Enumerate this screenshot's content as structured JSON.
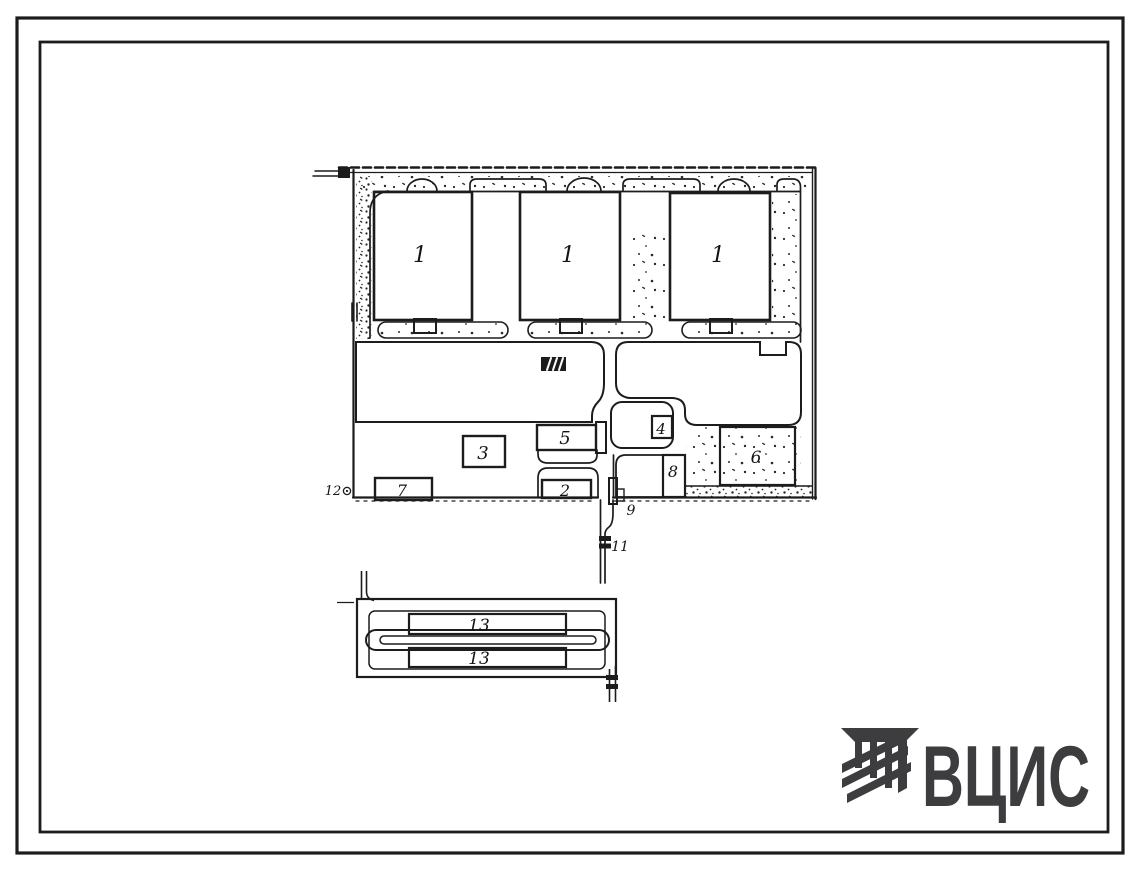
{
  "document": {
    "type": "site-plan-drawing",
    "sheet": "general plan with numbered objects"
  },
  "labels": {
    "b1a": "1",
    "b1b": "1",
    "b1c": "1",
    "b2": "2",
    "b3": "3",
    "b4": "4",
    "b5": "5",
    "b6": "6",
    "b7": "7",
    "b8": "8",
    "m9": "9",
    "m11": "11",
    "m12": "12",
    "b13a": "13",
    "b13b": "13"
  },
  "logo": {
    "text": "ВЦИС",
    "color": "#3d3d3f"
  },
  "colors": {
    "ink": "#1c1c1c",
    "paper": "#ffffff"
  }
}
